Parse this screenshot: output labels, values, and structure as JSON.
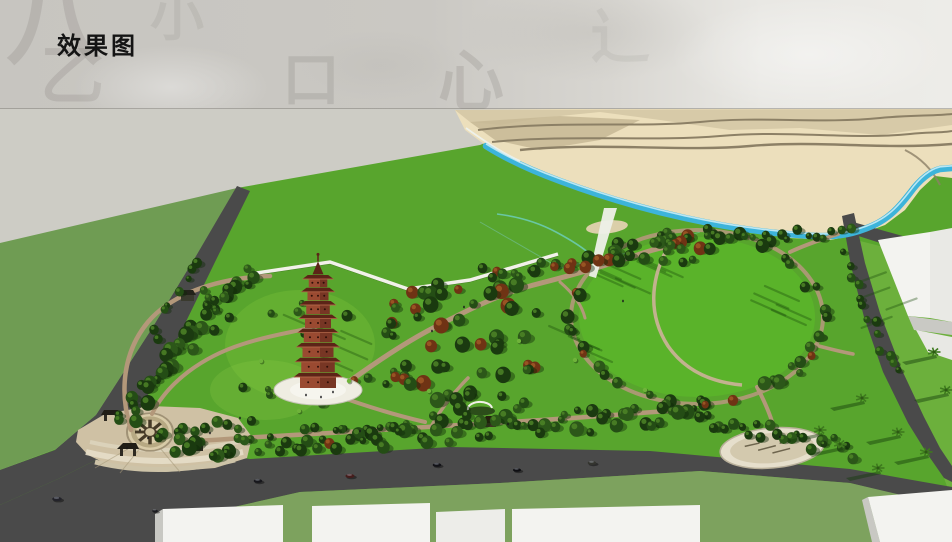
{
  "header": {
    "title": "效果图"
  },
  "scene": {
    "label": "park-aerial-rendering",
    "palette": {
      "header_left": "#c7c5c0",
      "header_right": "#e9e8e4",
      "title_color": "#141414",
      "ground_gray": "#cdccc5",
      "olive_field": "#6f9c53",
      "park_green": "#58a52d",
      "circular_lawn": "#5ab32a",
      "east_lawn": "#6cb03c",
      "verge_green": "#7da25e",
      "road": "#4a4a4a",
      "sand_light": "#ecdfbc",
      "sand_mid": "#d5c8a5",
      "sand_dark": "#c7b995",
      "sand_line": "#8c8066",
      "water": "#3db4da",
      "water_light": "#c8ecf6",
      "path_tan": "#b3987a",
      "path_light": "#c8b295",
      "plaza_tan": "#cfc1a4",
      "plaza_cream": "#e6dec9",
      "tree_dark": "#1b3a10",
      "tree_mid": "#2c5719",
      "tree_light": "#4e8427",
      "tree_red": "#6f3314",
      "palm_green": "#3e7a1e",
      "pagoda_body": "#9a4a31",
      "pagoda_roof": "#5c2417",
      "pagoda_base": "#efede2",
      "building_top": "#f3f3f0",
      "building_side": "#c8c8c3",
      "car_dark": "#1f1f24"
    }
  }
}
